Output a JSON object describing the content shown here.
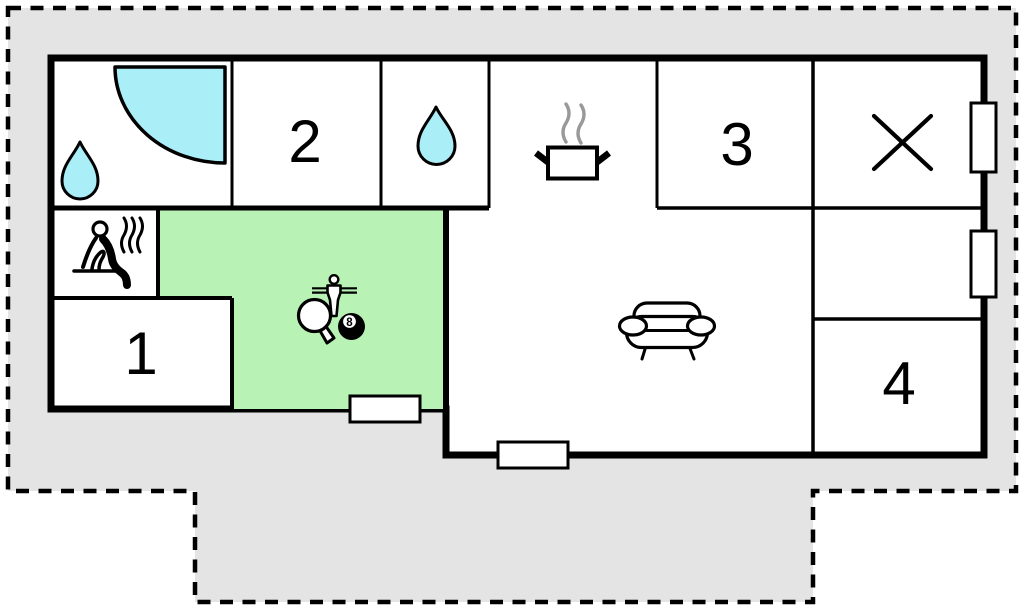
{
  "plan": {
    "type": "vacation-home-floor-plan",
    "room_labels": {
      "r1": "1",
      "r2": "2",
      "r3": "3",
      "r4": "4"
    },
    "eight_ball_label": "8",
    "colors": {
      "plot_fill": "#e4e4e4",
      "boundary_line": "#000000",
      "wall": "#000000",
      "room_fill": "#ffffff",
      "game_room_fill": "#b9f2b5",
      "water_fill": "#aaeef8",
      "steam": "#999999"
    },
    "icons": {
      "bathroom": [
        "water-drop",
        "corner-shower"
      ],
      "shower_room": [
        "water-drop"
      ],
      "kitchen": [
        "cooking-pot-with-steam"
      ],
      "sauna_room": [
        "sauna-person",
        "steam-waves"
      ],
      "game_room": [
        "table-tennis-paddle",
        "foosball-player",
        "eight-ball"
      ],
      "living_room": [
        "sofa"
      ],
      "closed_room": [
        "x-mark"
      ],
      "openings": [
        "door-opening-game-room",
        "door-opening-living-room",
        "window-right-top",
        "window-right-middle"
      ]
    }
  }
}
